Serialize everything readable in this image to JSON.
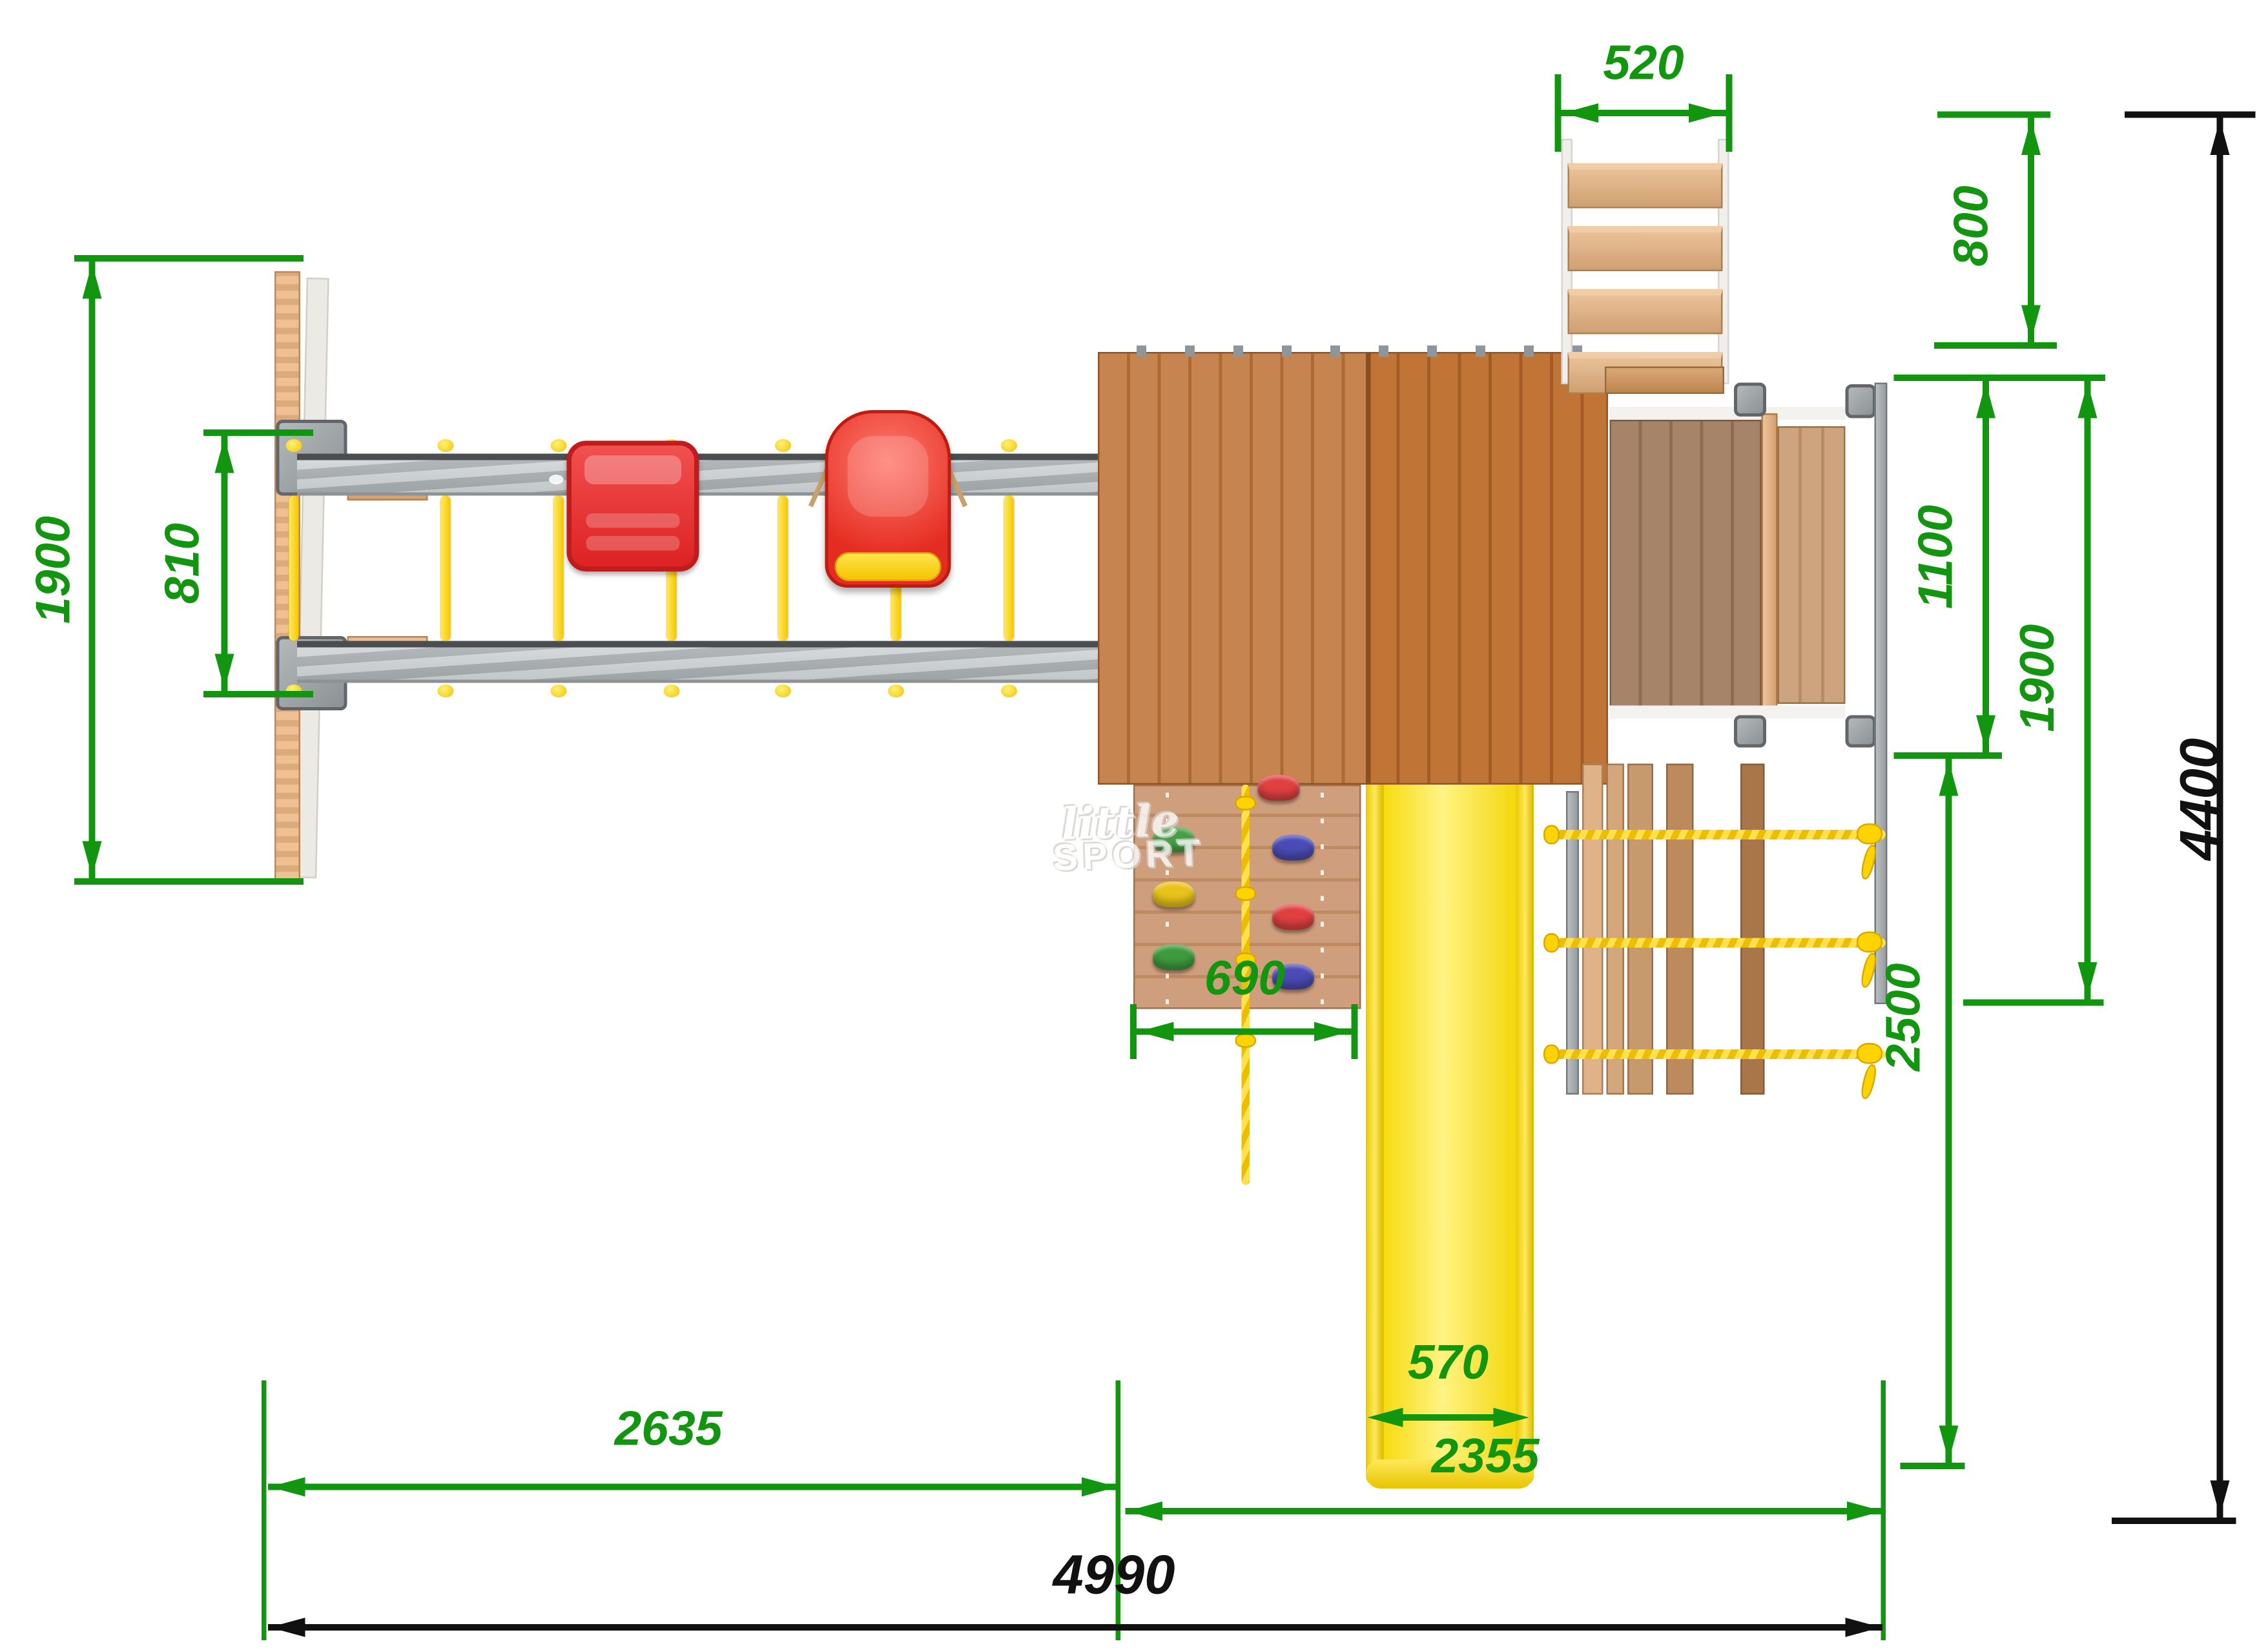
{
  "title": "Playground set top-view technical drawing",
  "units": "mm",
  "watermark": {
    "line1": "little",
    "line2": "SPORT"
  },
  "colors": {
    "dimension_green": "#12950f",
    "dimension_black": "#111111",
    "slide_yellow": "#ffe400",
    "swing_red": "#e93434",
    "rope_yellow": "#ffd300",
    "beam_gray": "#b9bdc0",
    "roof_wood": "#bd7a44",
    "light_wood": "#e8bb90"
  },
  "dimensions": {
    "stairs_width": "520",
    "stairs_depth": "800",
    "swing_frame_width": "1900",
    "swing_beams_spacing": "810",
    "platform_depth": "1100",
    "platform_with_ladder_depth": "1900",
    "total_depth": "4400",
    "climbing_wall_width": "690",
    "slide_width": "570",
    "slide_section_depth": "2500",
    "swing_section_length": "2635",
    "tower_section_length": "2355",
    "total_length": "4990"
  }
}
